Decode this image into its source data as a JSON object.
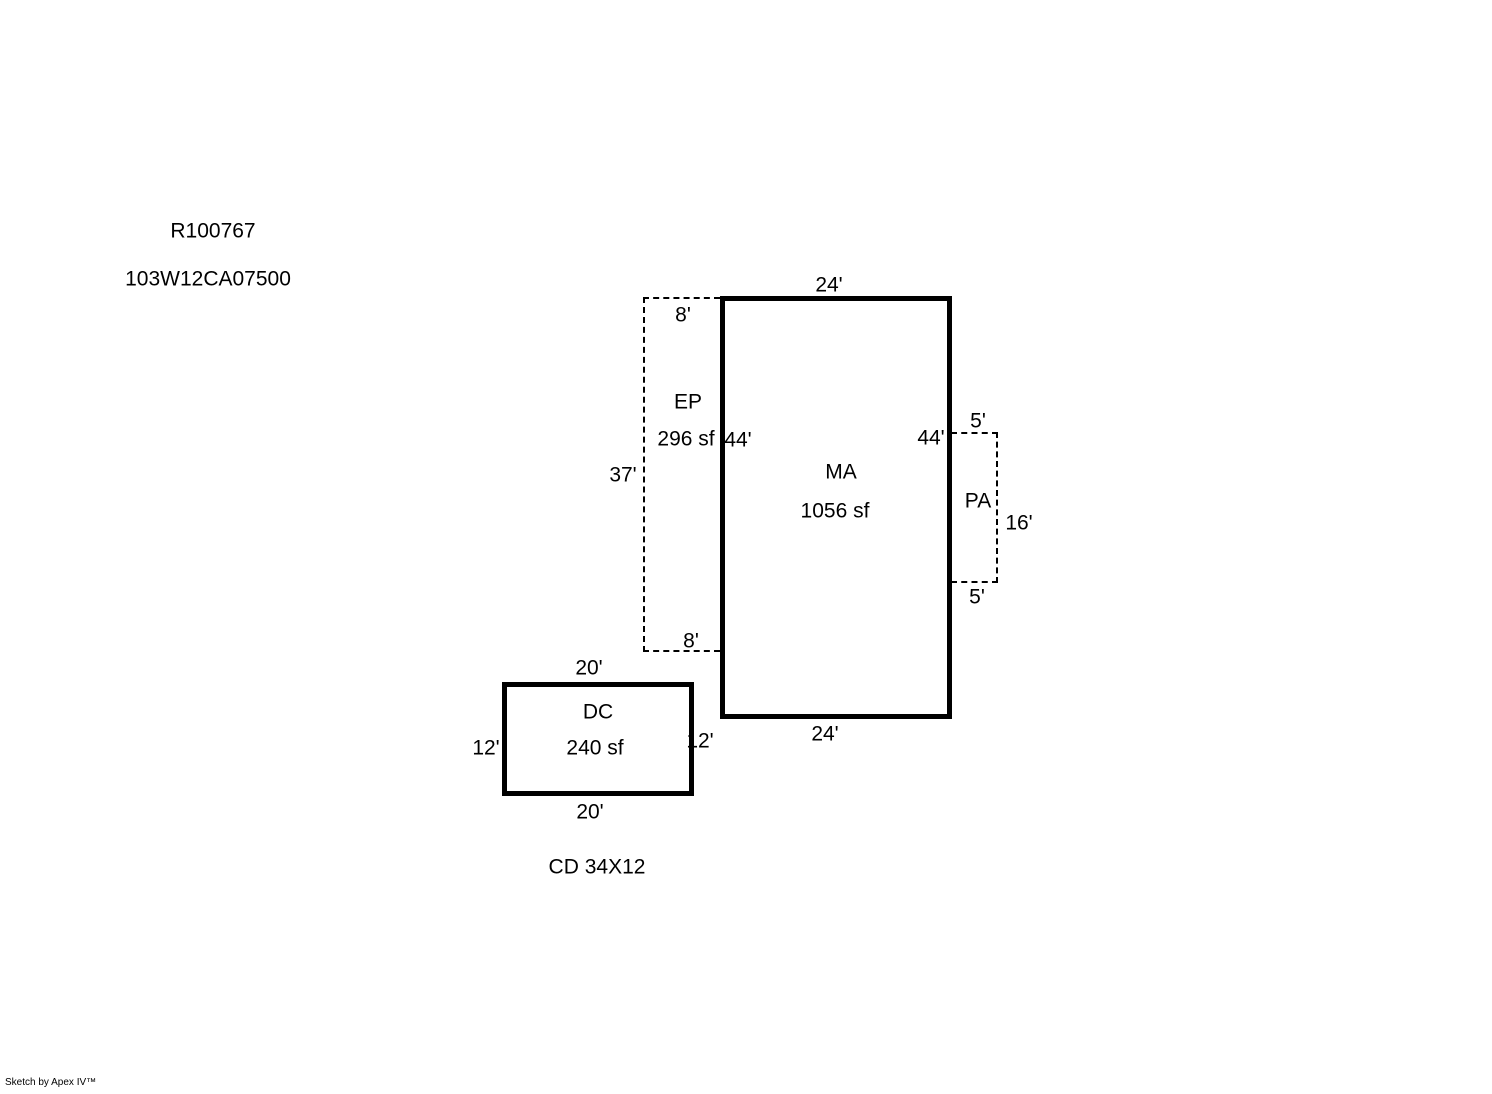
{
  "page": {
    "background_color": "#ffffff",
    "line_color": "#000000"
  },
  "header": {
    "record_id": "R100767",
    "parcel_id": "103W12CA07500"
  },
  "areas": {
    "ma": {
      "code": "MA",
      "size": "1056 sf",
      "outline": "solid",
      "dim_top": "24'",
      "dim_left": "44'",
      "dim_right": "44'",
      "dim_bottom": "24'"
    },
    "ep": {
      "code": "EP",
      "size": "296 sf",
      "outline": "dashed",
      "dim_top": "8'",
      "dim_left": "37'",
      "dim_bottom": "8'"
    },
    "pa": {
      "code": "PA",
      "outline": "dashed",
      "dim_top": "5'",
      "dim_right": "16'",
      "dim_bottom": "5'"
    },
    "dc": {
      "code": "DC",
      "size": "240 sf",
      "outline": "solid",
      "dim_top": "20'",
      "dim_left": "12'",
      "dim_right": "12'",
      "dim_bottom": "20'"
    }
  },
  "note": "CD 34X12",
  "footer": {
    "credit": "Sketch by Apex IV™"
  }
}
